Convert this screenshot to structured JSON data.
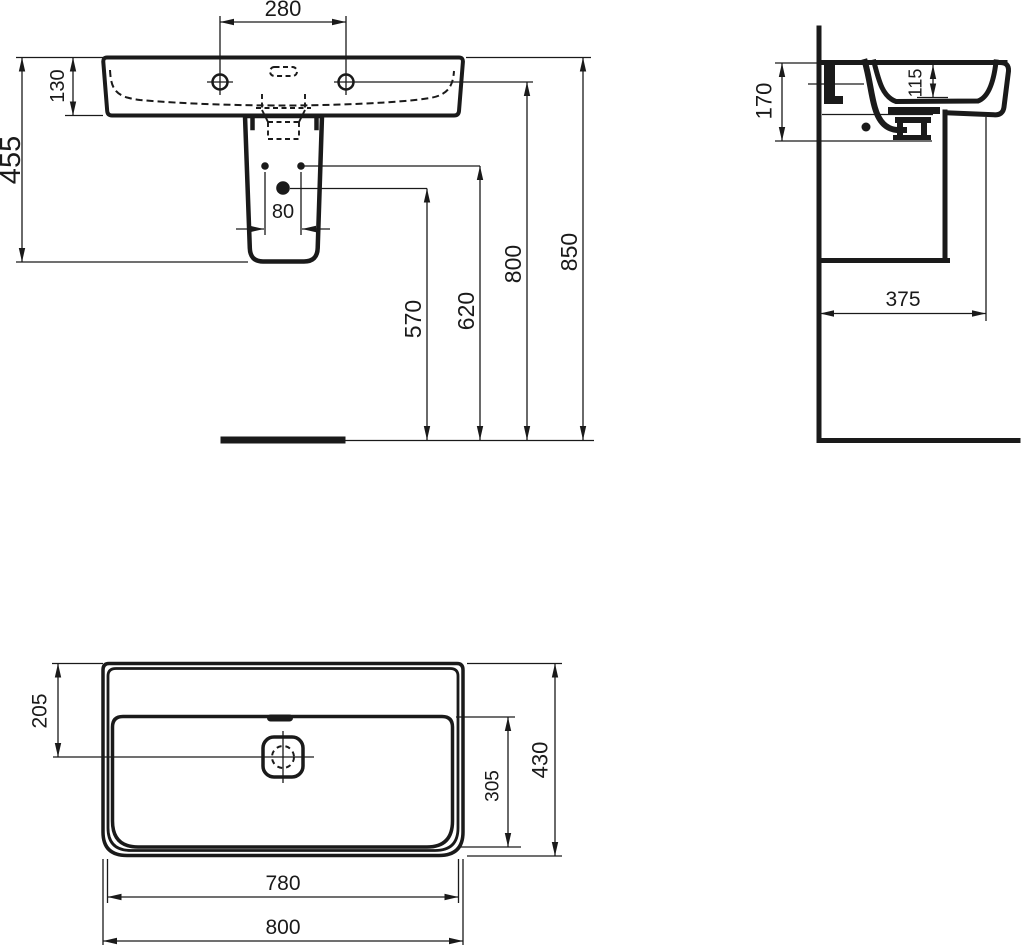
{
  "colors": {
    "ink": "#1a1a1a",
    "paper": "#ffffff"
  },
  "views": {
    "front": {
      "d280": "280",
      "d130": "130",
      "d455": "455",
      "d80": "80",
      "d570": "570",
      "d620": "620",
      "d800": "800",
      "d850": "850"
    },
    "side": {
      "d170": "170",
      "d115": "115",
      "d375": "375"
    },
    "plan": {
      "d205": "205",
      "d305": "305",
      "d430": "430",
      "d780": "780",
      "d800": "800"
    }
  }
}
